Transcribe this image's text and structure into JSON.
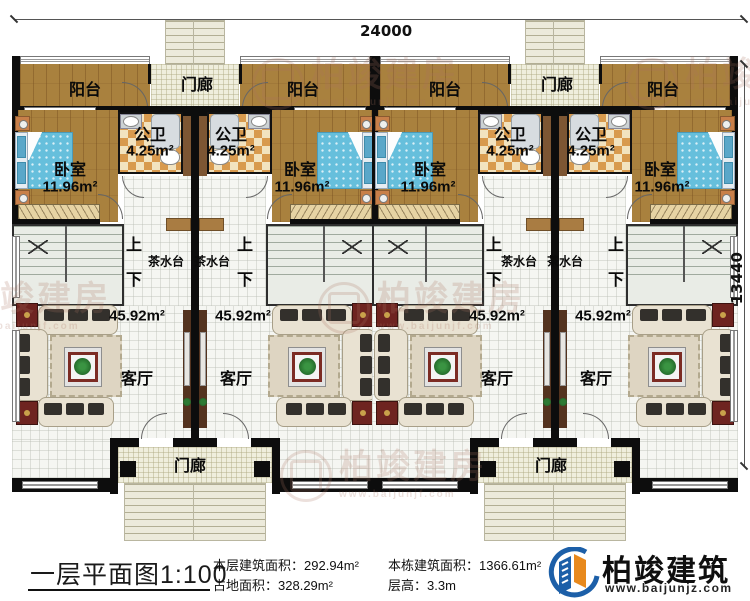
{
  "dimensions": {
    "top_width": "24000",
    "right_height": "13440"
  },
  "watermark": {
    "brand": "柏竣建房",
    "url": "www.baijunjf.com",
    "positions": [
      [
        252,
        58
      ],
      [
        626,
        58
      ],
      [
        318,
        282
      ],
      [
        -96,
        282
      ],
      [
        280,
        450
      ]
    ]
  },
  "room_labels": [
    {
      "t": "阳台",
      "x": 85,
      "y": 88,
      "s": 16
    },
    {
      "t": "阳台",
      "x": 303,
      "y": 88,
      "s": 16
    },
    {
      "t": "阳台",
      "x": 445,
      "y": 88,
      "s": 16
    },
    {
      "t": "阳台",
      "x": 663,
      "y": 88,
      "s": 16
    },
    {
      "t": "门廊",
      "x": 197,
      "y": 83,
      "s": 16
    },
    {
      "t": "门廊",
      "x": 557,
      "y": 83,
      "s": 16
    },
    {
      "t": "公卫",
      "x": 150,
      "y": 133,
      "s": 16
    },
    {
      "t": "4.25m²",
      "x": 150,
      "y": 151,
      "s": 15
    },
    {
      "t": "公卫",
      "x": 231,
      "y": 133,
      "s": 16
    },
    {
      "t": "4.25m²",
      "x": 231,
      "y": 151,
      "s": 15
    },
    {
      "t": "公卫",
      "x": 510,
      "y": 133,
      "s": 16
    },
    {
      "t": "4.25m²",
      "x": 510,
      "y": 151,
      "s": 15
    },
    {
      "t": "公卫",
      "x": 591,
      "y": 133,
      "s": 16
    },
    {
      "t": "4.25m²",
      "x": 591,
      "y": 151,
      "s": 15
    },
    {
      "t": "卧室",
      "x": 70,
      "y": 168,
      "s": 16
    },
    {
      "t": "11.96m²",
      "x": 70,
      "y": 187,
      "s": 15
    },
    {
      "t": "卧室",
      "x": 300,
      "y": 168,
      "s": 16
    },
    {
      "t": "11.96m²",
      "x": 302,
      "y": 187,
      "s": 15
    },
    {
      "t": "卧室",
      "x": 430,
      "y": 168,
      "s": 16
    },
    {
      "t": "11.96m²",
      "x": 428,
      "y": 187,
      "s": 15
    },
    {
      "t": "卧室",
      "x": 660,
      "y": 168,
      "s": 16
    },
    {
      "t": "11.96m²",
      "x": 662,
      "y": 187,
      "s": 15
    },
    {
      "t": "上",
      "x": 134,
      "y": 243,
      "s": 16
    },
    {
      "t": "下",
      "x": 134,
      "y": 278,
      "s": 16
    },
    {
      "t": "上",
      "x": 245,
      "y": 243,
      "s": 16
    },
    {
      "t": "下",
      "x": 245,
      "y": 278,
      "s": 16
    },
    {
      "t": "上",
      "x": 494,
      "y": 243,
      "s": 16
    },
    {
      "t": "下",
      "x": 494,
      "y": 278,
      "s": 16
    },
    {
      "t": "上",
      "x": 616,
      "y": 243,
      "s": 16
    },
    {
      "t": "下",
      "x": 616,
      "y": 278,
      "s": 16
    },
    {
      "t": "茶水台",
      "x": 166,
      "y": 261,
      "s": 12
    },
    {
      "t": "茶水台",
      "x": 212,
      "y": 261,
      "s": 12
    },
    {
      "t": "茶水台",
      "x": 519,
      "y": 261,
      "s": 12
    },
    {
      "t": "茶水台",
      "x": 565,
      "y": 261,
      "s": 12
    },
    {
      "t": "45.92m²",
      "x": 137,
      "y": 316,
      "s": 15
    },
    {
      "t": "客厅",
      "x": 137,
      "y": 377,
      "s": 16
    },
    {
      "t": "45.92m²",
      "x": 243,
      "y": 316,
      "s": 15
    },
    {
      "t": "客厅",
      "x": 236,
      "y": 377,
      "s": 16
    },
    {
      "t": "45.92m²",
      "x": 497,
      "y": 316,
      "s": 15
    },
    {
      "t": "客厅",
      "x": 497,
      "y": 377,
      "s": 16
    },
    {
      "t": "45.92m²",
      "x": 603,
      "y": 316,
      "s": 15
    },
    {
      "t": "客厅",
      "x": 596,
      "y": 377,
      "s": 16
    },
    {
      "t": "门廊",
      "x": 190,
      "y": 464,
      "s": 16
    },
    {
      "t": "门廊",
      "x": 551,
      "y": 464,
      "s": 16
    }
  ],
  "footer": {
    "title": "一层平面图1:100",
    "stats": [
      {
        "label": "本层建筑面积：",
        "value": "292.94m²"
      },
      {
        "label": "占地面积：",
        "value": "328.29m²"
      },
      {
        "label": "本栋建筑面积：",
        "value": "1366.61m²"
      },
      {
        "label": "层高：",
        "value": "3.3m"
      }
    ],
    "logo_name": "柏竣建筑",
    "logo_url": "www.baijunjz.com",
    "colors": {
      "logo_blue": "#1c5fa8",
      "logo_orange": "#e8891d"
    }
  }
}
